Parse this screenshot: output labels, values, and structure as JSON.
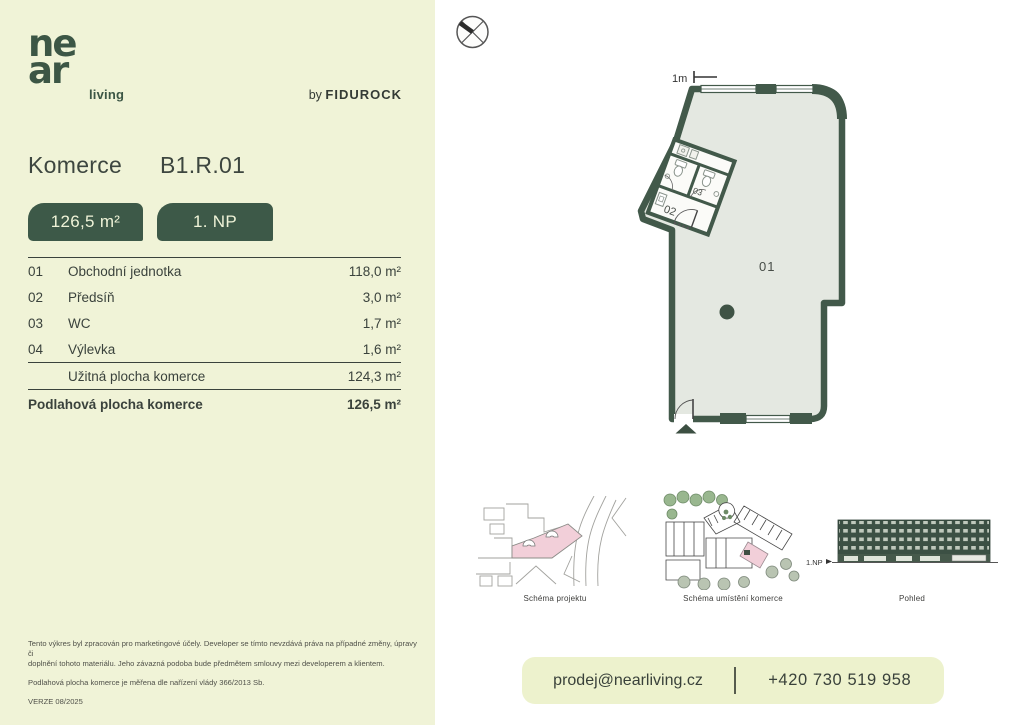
{
  "brand": {
    "logo_line1": "ne",
    "logo_line2": "ar",
    "logo_suffix": "living",
    "byline_prefix": "by",
    "byline_brand": "FIDUROCK"
  },
  "header": {
    "title": "Komerce",
    "unit_code": "B1.R.01",
    "area_badge": "126,5 m²",
    "floor_badge": "1. NP"
  },
  "rooms": {
    "rows": [
      {
        "num": "01",
        "name": "Obchodní jednotka",
        "area": "118,0 m²"
      },
      {
        "num": "02",
        "name": "Předsíň",
        "area": "3,0 m²"
      },
      {
        "num": "03",
        "name": "WC",
        "area": "1,7 m²"
      },
      {
        "num": "04",
        "name": "Výlevka",
        "area": "1,6 m²"
      }
    ],
    "subtotal": {
      "name": "Užitná plocha komerce",
      "area": "124,3 m²"
    },
    "total": {
      "name": "Podlahová plocha komerce",
      "area": "126,5 m²"
    }
  },
  "plan": {
    "scale_label": "1m",
    "labels": {
      "main": "01",
      "hall": "02",
      "wc": "03"
    }
  },
  "figures": [
    {
      "caption": "Schéma projektu"
    },
    {
      "caption": "Schéma umístění komerce"
    },
    {
      "caption": "Pohled",
      "floor_marker": "1.NP"
    }
  ],
  "footer": {
    "disclaimer_lines": [
      "Tento výkres byl zpracován pro marketingové účely. Developer se tímto nevzdává práva na případné změny, úpravy či",
      "doplnění tohoto materiálu. Jeho závazná podoba bude předmětem smlouvy mezi developerem a klientem."
    ],
    "measure_note": "Podlahová plocha komerce je měřena dle nařízení vlády 366/2013 Sb.",
    "version": "VERZE 08/2025",
    "contact_email": "prodej@nearliving.cz",
    "contact_phone": "+420 730 519 958"
  },
  "colors": {
    "cream_panel": "#f0f3d7",
    "contact_bar": "#edf2cd",
    "dark_green": "#3d5948",
    "wall_green": "#42594a",
    "plan_floor": "#e4e8e1",
    "highlight_pink": "#f2cfd9",
    "facade_green": "#3c5044"
  }
}
